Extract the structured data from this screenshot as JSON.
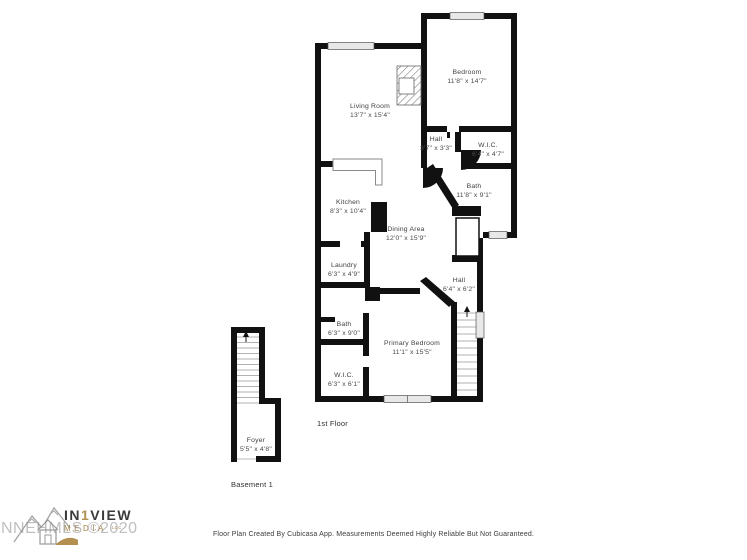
{
  "watermark": "NNEHMLS ©2020",
  "logo": {
    "part1": "IN",
    "part2": "1",
    "part3": "VIEW",
    "line2": "MEDIA",
    "suffix": "LLC"
  },
  "footer": "Floor Plan Created By Cubicasa App. Measurements Deemed Highly Reliable But Not Guaranteed.",
  "floors": {
    "first": {
      "label": "1st Floor",
      "rooms": [
        {
          "name": "Living Room",
          "dims": "13'7\" x 15'4\""
        },
        {
          "name": "Bedroom",
          "dims": "11'8\" x 14'7\""
        },
        {
          "name": "Hall",
          "dims": "3'7\" x 3'3\""
        },
        {
          "name": "W.I.C.",
          "dims": "6'4\" x 4'7\""
        },
        {
          "name": "Bath",
          "dims": "11'8\" x 9'1\""
        },
        {
          "name": "Kitchen",
          "dims": "8'3\" x 10'4\""
        },
        {
          "name": "Dining Area",
          "dims": "12'0\" x 15'9\""
        },
        {
          "name": "Laundry",
          "dims": "6'3\" x 4'9\""
        },
        {
          "name": "Hall",
          "dims": "6'4\" x 6'2\""
        },
        {
          "name": "Bath",
          "dims": "6'3\" x 9'0\""
        },
        {
          "name": "Primary Bedroom",
          "dims": "11'1\" x 15'5\""
        },
        {
          "name": "W.I.C.",
          "dims": "6'3\" x 6'1\""
        }
      ]
    },
    "basement": {
      "label": "Basement 1",
      "rooms": [
        {
          "name": "Foyer",
          "dims": "5'5\" x 4'8\""
        }
      ]
    }
  },
  "colors": {
    "wall": "#111111",
    "window_fill": "#e8e8e8",
    "accent_gold": "#b3904f",
    "label": "#3f3f3f"
  }
}
